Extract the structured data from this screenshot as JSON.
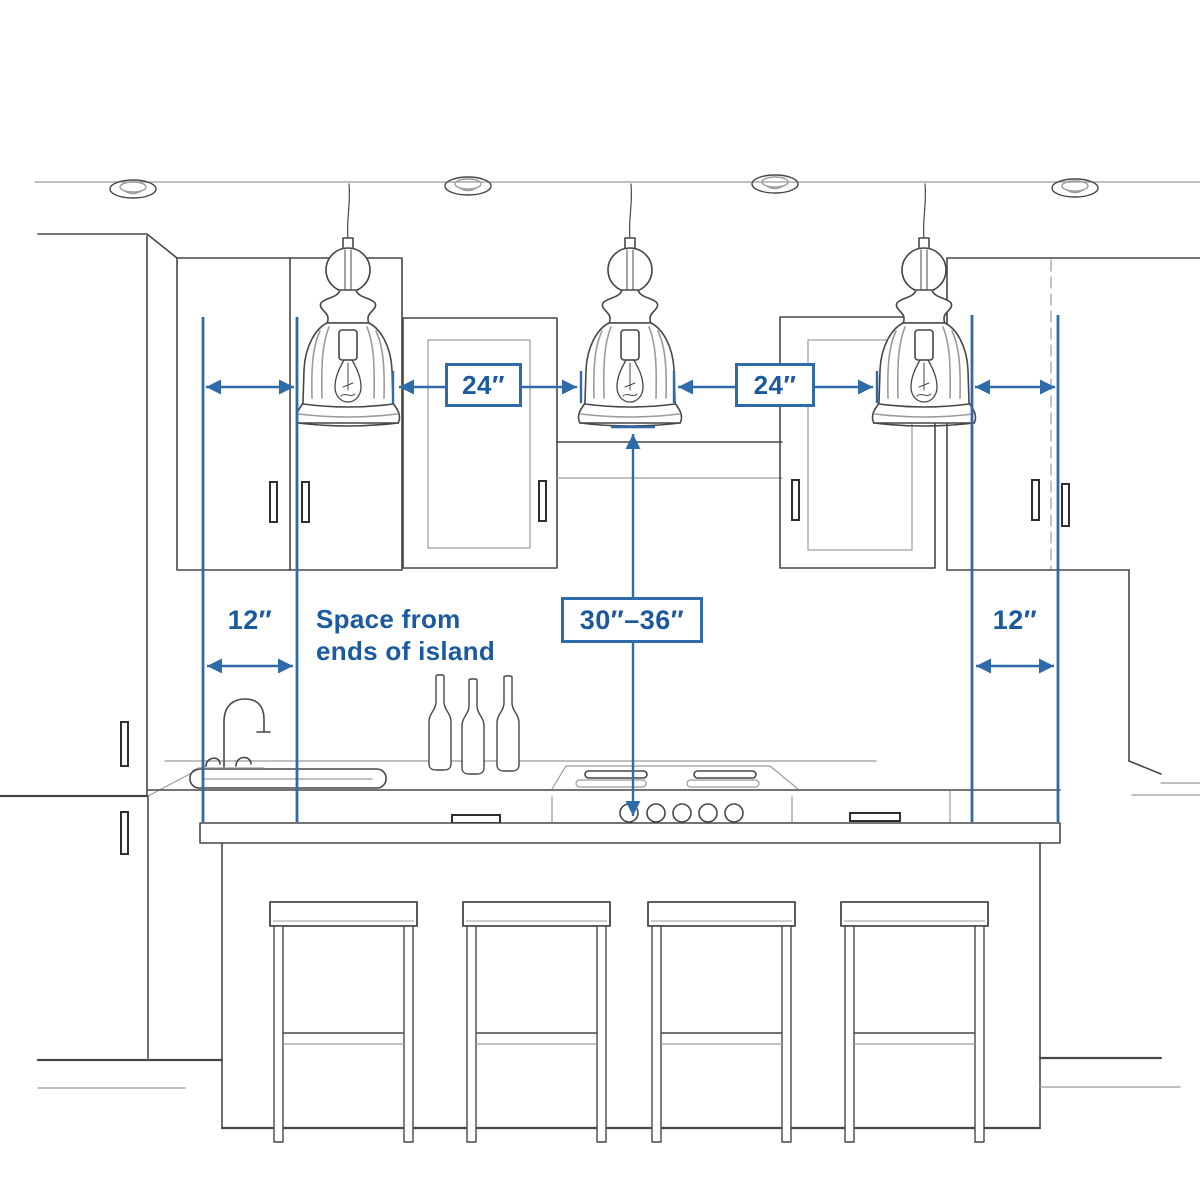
{
  "diagram_type": "kitchen pendant lighting spacing guide",
  "labels": {
    "gap_left": "24″",
    "gap_right": "24″",
    "end_left": "12″",
    "end_right": "12″",
    "height_range": "30″–36″",
    "note": "Space from\nends of island"
  },
  "colors": {
    "dimension_blue": "#2e6ba8",
    "label_text_blue": "#1b5a9e",
    "sketch_dark": "#474747",
    "sketch_light": "#9b9b9b",
    "background": "#ffffff"
  },
  "scene": {
    "pendant_count": 3,
    "recessed_ceiling_light_count": 4,
    "bar_stool_count": 4,
    "bottle_count": 3,
    "cooktop_knob_count": 5
  }
}
